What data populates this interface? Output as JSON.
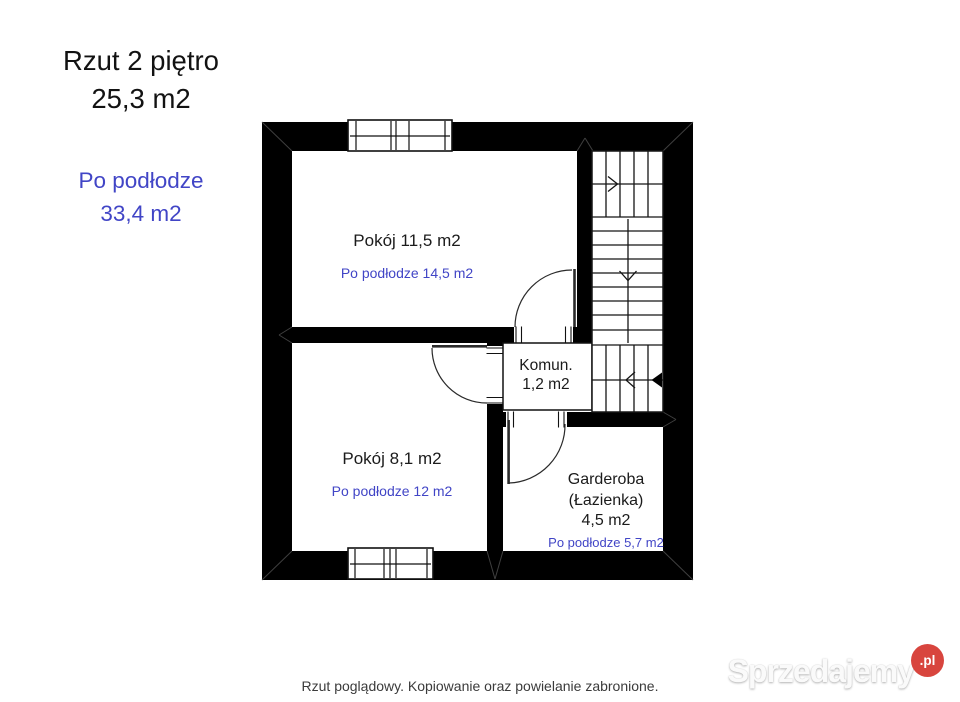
{
  "header": {
    "title_line1": "Rzut 2 piętro",
    "title_line2": "25,3 m2",
    "floor_line1": "Po podłodze",
    "floor_line2": "33,4 m2"
  },
  "rooms": {
    "room_top": {
      "name": "Pokój 11,5 m2",
      "floor_area": "Po podłodze 14,5 m2"
    },
    "room_bottom": {
      "name": "Pokój 8,1 m2",
      "floor_area": "Po podłodze 12 m2"
    },
    "hallway": {
      "line1": "Komun.",
      "line2": "1,2 m2"
    },
    "wardrobe": {
      "line1": "Garderoba",
      "line2": "(Łazienka)",
      "line3": "4,5 m2",
      "floor_area": "Po podłodze 5,7 m2"
    }
  },
  "footer": {
    "disclaimer": "Rzut poglądowy. Kopiowanie oraz powielanie zabronione."
  },
  "watermark": {
    "brand": "Sprzedajemy",
    "tld": ".pl"
  },
  "colors": {
    "wall": "#000000",
    "accent_blue": "#4145c6",
    "badge_red": "#d8453e",
    "title_text": "#121212",
    "footer_text": "#3b3b3b"
  }
}
